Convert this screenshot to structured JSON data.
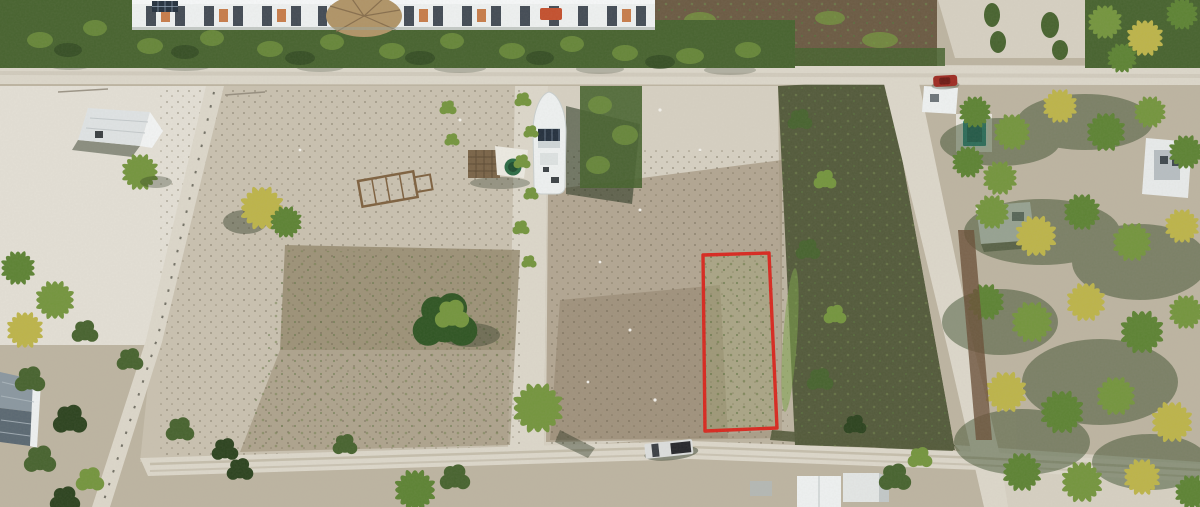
{
  "scene": {
    "description": "Aerial drone photograph of coastal vacant land lots with dirt roads, palm groves and white houses; one rectangular lot is outlined in red",
    "plot": {
      "outline_color": "#d8281f",
      "shape": "rectangle",
      "position": "center-right of frame"
    }
  },
  "palette": {
    "sandBase": "#c7bfae",
    "sandBright": "#e3dfd5",
    "sandLight": "#d6d0c2",
    "sandMid": "#bdb4a1",
    "earth": "#a3947e",
    "earthDark": "#8d7d68",
    "scrubDark": "#535a3b",
    "scrubBrown": "#6b5a43",
    "veg": "#47632f",
    "vegLight": "#74953e",
    "vegDark": "#2c431f",
    "palmGreen": "#5d8334",
    "palmYellow": "#bdb44a",
    "road": "#dcd7ca",
    "roadEdge": "#b4ab98",
    "shadow": "#1d2b16",
    "white": "#eef1f1",
    "roofGray": "#b7bec2",
    "roofDark": "#5a6872",
    "poolTeal": "#2f8e8a",
    "carRed": "#9e2b22",
    "truckBody": "#dcdedd",
    "truckBed": "#26272b",
    "tankGreen": "#2c6b45",
    "palapaBrown": "#7a6448",
    "thatchTan": "#b09467",
    "panelBlue": "#24303e",
    "accentOrange": "#c77c4a"
  }
}
